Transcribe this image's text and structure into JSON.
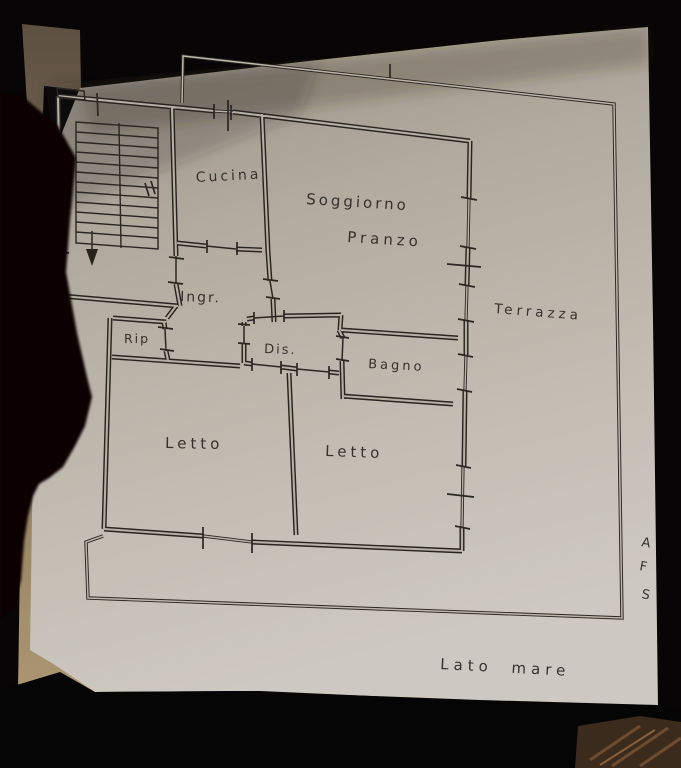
{
  "photo": {
    "subject": "Photograph of a hand-drawn apartment floor plan on paper",
    "colors": {
      "background": "#070505",
      "paper": "#b4ada1",
      "ink": "#282420",
      "handwriting": "#2a2723",
      "table_tan": "#a8916c",
      "wood": "#3b2b1d",
      "shadow": "#0a0807"
    }
  },
  "labels": {
    "cucina": "Cucina",
    "soggiorno": "Soggiorno",
    "pranzo": "Pranzo",
    "ingresso": "Ingr.",
    "ripostiglio": "Rip",
    "disimpegno": "Dis.",
    "bagno": "Bagno",
    "letto1": "Letto",
    "letto2": "Letto",
    "terrazza": "Terrazza",
    "lato_mare": "Lato mare",
    "edge_letters": [
      "A",
      "F",
      "S"
    ]
  },
  "stairs": {
    "arrow_direction": "down"
  }
}
